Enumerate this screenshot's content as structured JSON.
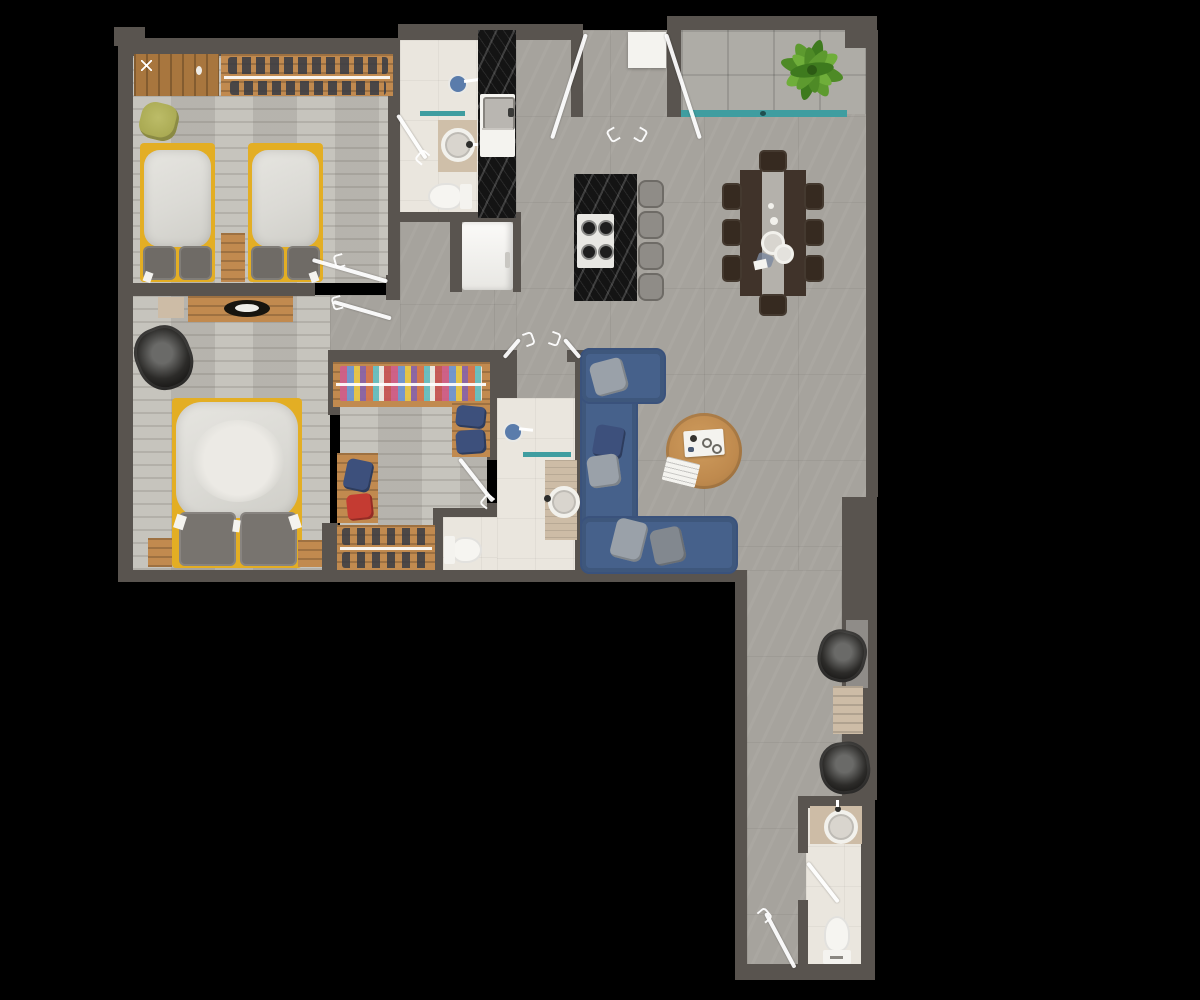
{
  "meta": {
    "type": "2d-floor-plan-rendering",
    "view": "top-down",
    "description": "Rendered top-down apartment floor plan on black background"
  },
  "palette": {
    "background": "#000000",
    "wall": "#59544f",
    "wallLight": "#8f8c88",
    "floorMain": "#a6a39d",
    "floorWood": "#c0bdb6",
    "floorBath": "#eae6de",
    "floorBalcony": "#aeaca6",
    "marble": "#141414",
    "wood": "#c18a4f",
    "woodDark": "#a8763e",
    "yellow": "#e3ae24",
    "duvet": "#dbdad5",
    "pillow": "#6f6b66",
    "sofa": "#46618b",
    "sofaDark": "#3a527c",
    "cushion": "#9aa1a9",
    "navy": "#3d507c",
    "red": "#c43b32",
    "teal": "#3f9da0",
    "green": "#5d9a2f",
    "greenDark": "#3e7a1e",
    "olive": "#a9a952",
    "chairDark": "#362a20",
    "tableDark": "#40332a",
    "runner": "#b4b1ab",
    "steel": "#8f8c87",
    "beige": "#cdbca6",
    "white": "#f4f3ef"
  },
  "rooms": [
    {
      "id": "bedroom-twin",
      "name": "Twin Bedroom",
      "furniture": [
        "wardrobe",
        "hanging-closet",
        "twin-bed-left",
        "twin-bed-right",
        "nightstand",
        "beanbag",
        "door"
      ]
    },
    {
      "id": "bathroom-top",
      "name": "Bathroom 1",
      "furniture": [
        "shower-head",
        "glass-shelf",
        "round-sink",
        "toilet",
        "door"
      ]
    },
    {
      "id": "kitchen",
      "name": "Kitchen",
      "furniture": [
        "marble-counter",
        "counter-sink",
        "refrigerator",
        "marble-island",
        "stove-4-burner",
        "bar-stool-x4"
      ]
    },
    {
      "id": "entry",
      "name": "Entry",
      "furniture": [
        "double-door",
        "doormat"
      ]
    },
    {
      "id": "balcony",
      "name": "Balcony",
      "furniture": [
        "plant",
        "glass-railing"
      ]
    },
    {
      "id": "dining",
      "name": "Dining Area",
      "furniture": [
        "dining-table",
        "dining-chair-x8",
        "tableware"
      ]
    },
    {
      "id": "living",
      "name": "Living Area",
      "furniture": [
        "sectional-sofa",
        "cushion-x5",
        "round-coffee-table",
        "tray",
        "magazine",
        "double-door-glyphs"
      ]
    },
    {
      "id": "bedroom-master",
      "name": "Master Bedroom",
      "furniture": [
        "double-bed",
        "nightstand-left",
        "nightstand-right",
        "dresser-tv",
        "bench",
        "armchair",
        "door"
      ]
    },
    {
      "id": "walk-in-closet",
      "name": "Walk-in Closet",
      "furniture": [
        "clothes-rail",
        "shelf-navy-boxes",
        "desk-blue-bag",
        "desk-red-box",
        "shoe-rack"
      ]
    },
    {
      "id": "bathroom-ensuite",
      "name": "Ensuite Bathroom",
      "furniture": [
        "shower-head",
        "glass-shelf",
        "sink-counter",
        "toilet",
        "door"
      ]
    },
    {
      "id": "corridor",
      "name": "Corridor",
      "furniture": [
        "armchair-upper",
        "console-table",
        "armchair-lower",
        "wall-niche",
        "door"
      ]
    },
    {
      "id": "bathroom-guest",
      "name": "Guest Bathroom",
      "furniture": [
        "sink-counter",
        "toilet",
        "door"
      ]
    }
  ]
}
